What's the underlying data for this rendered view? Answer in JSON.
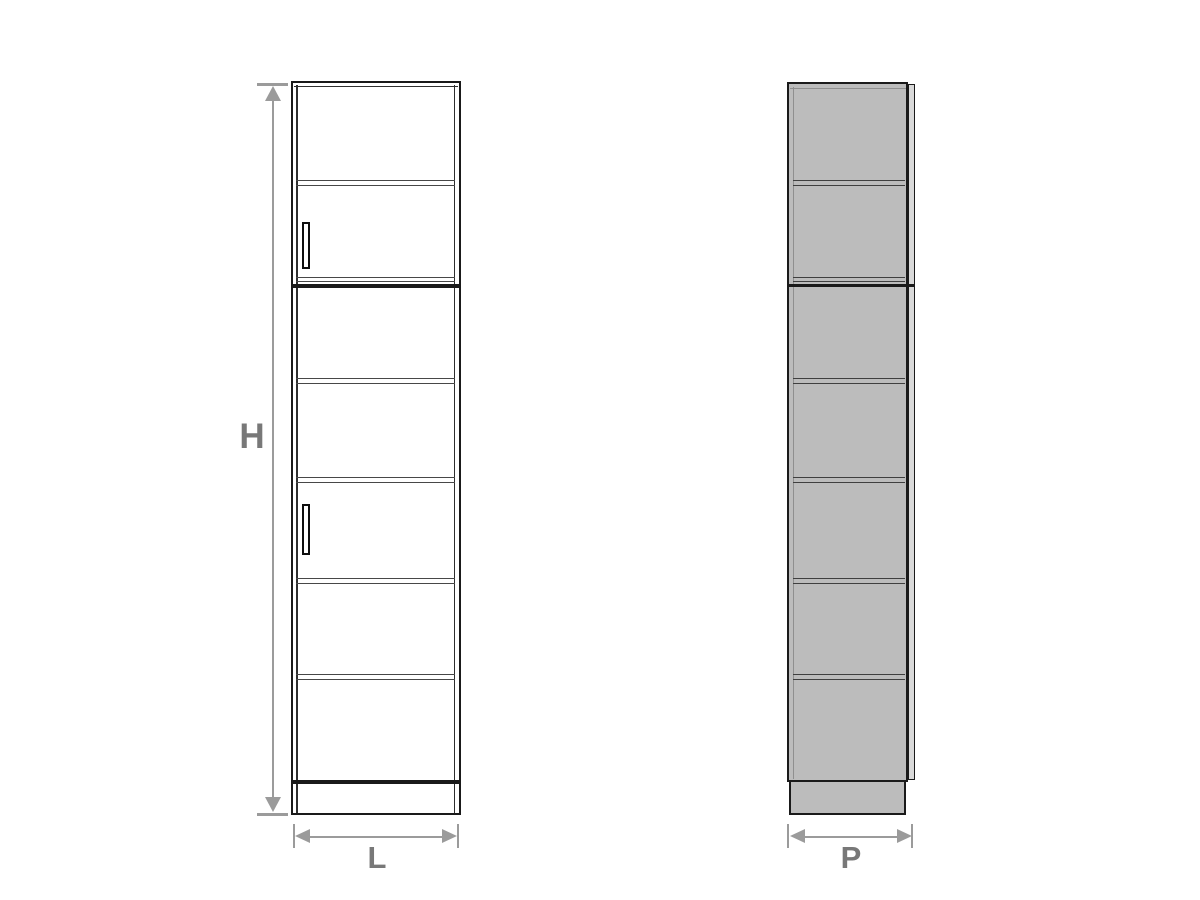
{
  "diagram": {
    "type": "furniture-dimension-drawing",
    "subject": "tall cabinet with shelves and two doors, front and side elevation views",
    "labels": {
      "height": "H",
      "width": "L",
      "depth": "P"
    },
    "colors": {
      "outline": "#1a1a1a",
      "front_fill": "#ffffff",
      "side_fill": "#bcbcbc",
      "door_edge_fill": "#d9d9d9",
      "dimension": "#9b9b9b",
      "label_text": "#787878"
    }
  }
}
